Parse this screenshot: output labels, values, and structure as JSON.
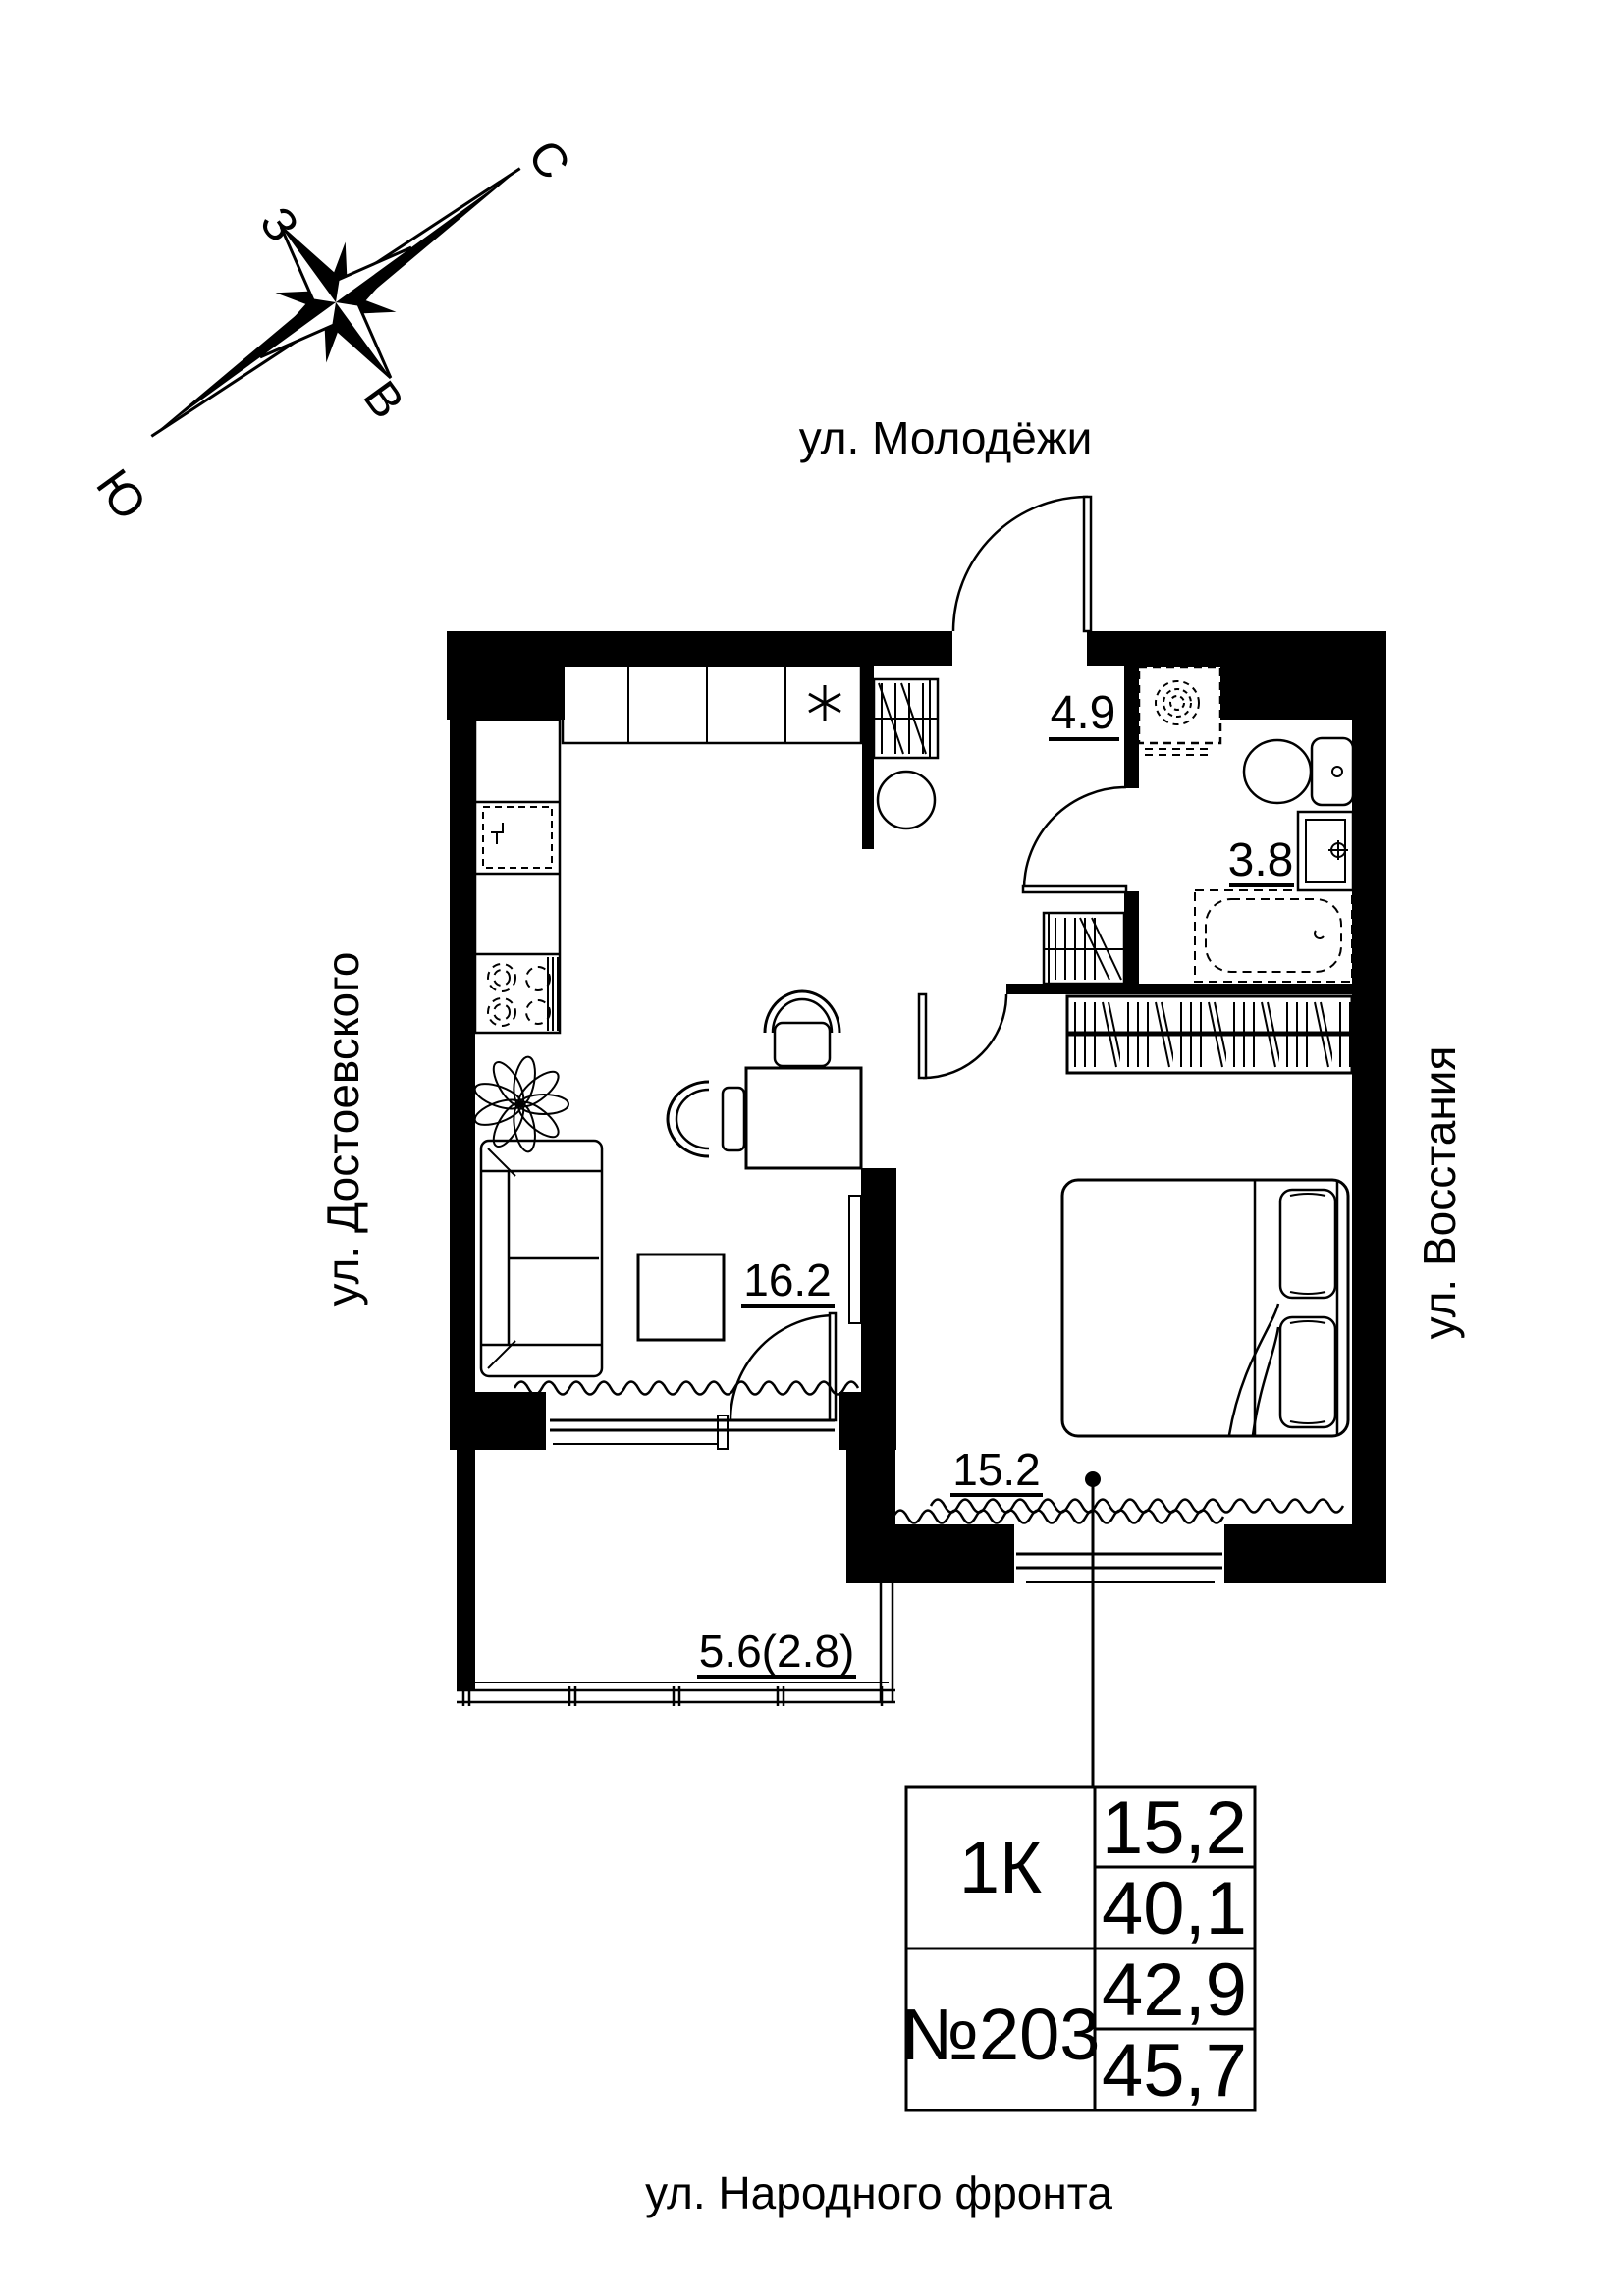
{
  "compass": {
    "north": "С",
    "south": "Ю",
    "west": "З",
    "east": "В"
  },
  "streets": {
    "top": "ул. Молодёжи",
    "left": "ул. Достоевского",
    "right": "ул. Восстания",
    "bottom": "ул. Народного фронта"
  },
  "rooms": {
    "hall": {
      "label": "4.9"
    },
    "bathroom": {
      "label": "3.8"
    },
    "living": {
      "label": "16.2"
    },
    "bedroom": {
      "label": "15.2"
    },
    "balcony": {
      "label": "5.6(2.8)"
    }
  },
  "info_table": {
    "type": "1К",
    "number": "№203",
    "values": [
      "15,2",
      "40,1",
      "42,9",
      "45,7"
    ]
  },
  "colors": {
    "ink": "#000000",
    "paper": "#ffffff"
  }
}
